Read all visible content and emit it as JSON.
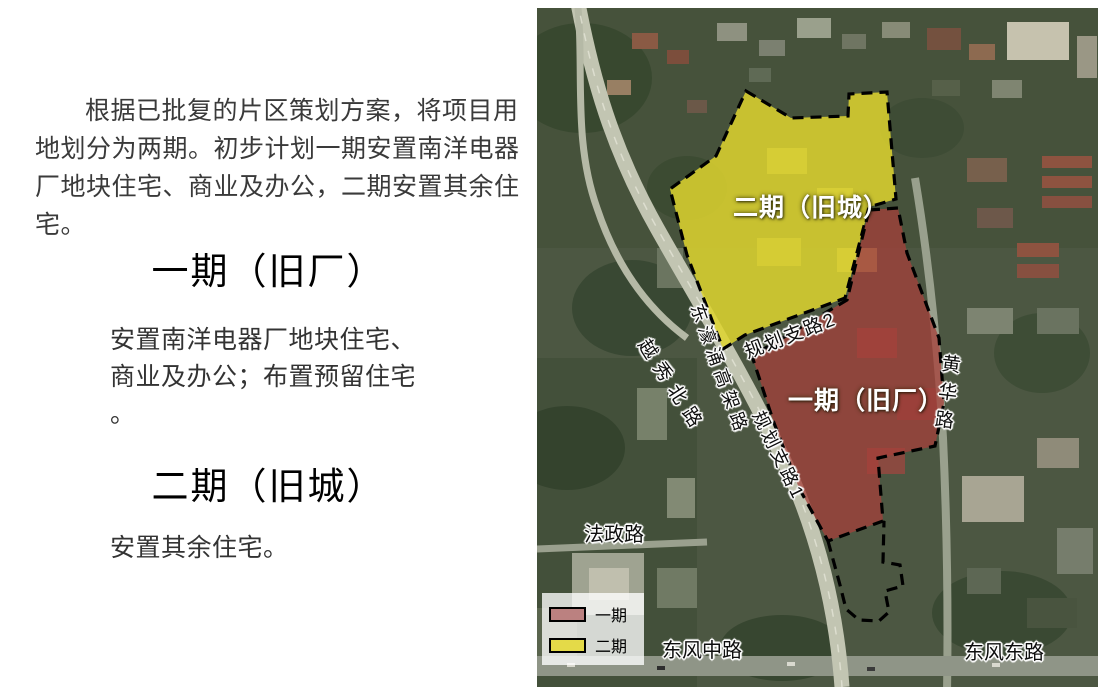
{
  "left_panel": {
    "intro": "根据已批复的片区策划方案，将项目用地划分为两期。初步计划一期安置南洋电器厂地块住宅、商业及办公，二期安置其余住宅。",
    "phase1": {
      "title": "一期（旧厂）",
      "desc": "安置南洋电器厂地块住宅、\n商业及办公；布置预留住宅\n。"
    },
    "phase2": {
      "title": "二期（旧城）",
      "desc": "安置其余住宅。"
    }
  },
  "map": {
    "zone_labels": {
      "phase2": "二期（旧城）",
      "phase1": "一期（旧厂）"
    },
    "road_labels": {
      "yuexiu_north": "越秀北路",
      "donghaochong_elevated": "东濠涌高架路",
      "planned_road_2": "规划支路2",
      "planned_road_1": "规划支路1",
      "huanghua": "黄华路",
      "fazheng": "法政路",
      "dongfeng_middle": "东风中路",
      "dongfeng_east": "东风东路"
    },
    "legend": {
      "items": [
        {
          "label": "一期",
          "color": "#bb8180"
        },
        {
          "label": "二期",
          "color": "#e4da48"
        }
      ]
    },
    "colors": {
      "phase1_zone_fill": "#a63f3a",
      "phase2_zone_fill": "#ddd42f",
      "boundary": "#000000"
    }
  }
}
